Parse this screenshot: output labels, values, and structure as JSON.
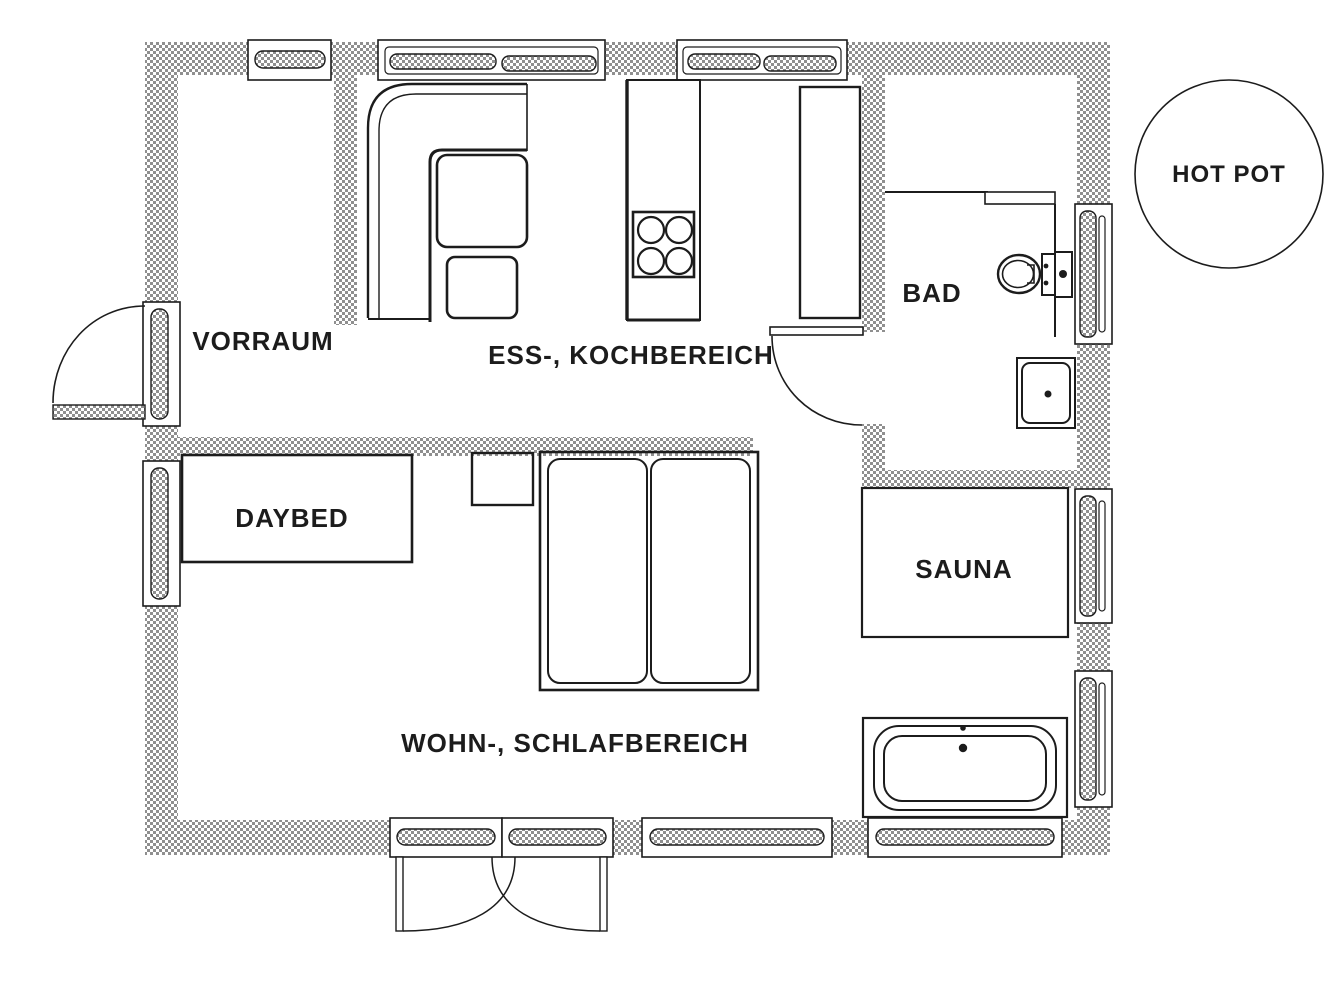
{
  "plan": {
    "labels": {
      "vorraum": "VORRAUM",
      "ess_kochbereich": "ESS-, KOCHBEREICH",
      "bad": "BAD",
      "daybed": "DAYBED",
      "sauna": "SAUNA",
      "wohn_schlafbereich": "WOHN-, SCHLAFBEREICH",
      "hot_pot": "HOT POT"
    },
    "colors": {
      "background": "#ffffff",
      "wall_hatch": "#8f8f8f",
      "line": "#1c1c1c"
    }
  }
}
